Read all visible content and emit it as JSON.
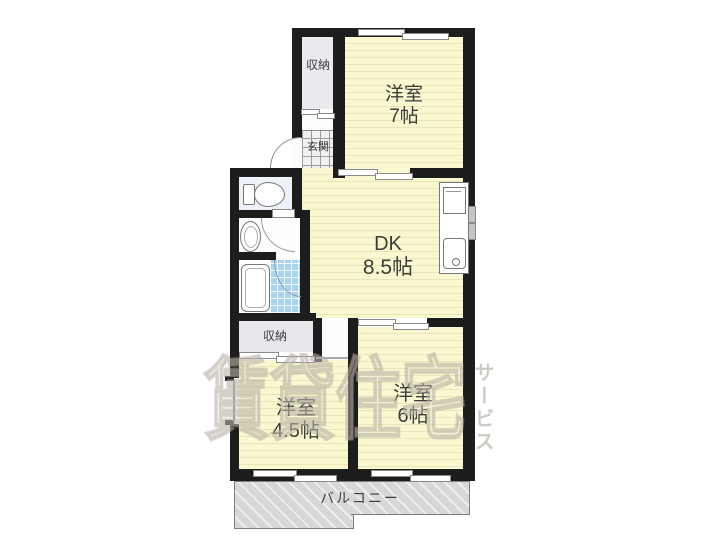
{
  "rooms": {
    "closet_top": {
      "label": "収納"
    },
    "western7": {
      "name": "洋室",
      "size": "7帖"
    },
    "genkan": {
      "label": "玄関"
    },
    "dk": {
      "name": "DK",
      "size": "8.5帖"
    },
    "closet_bottom": {
      "label": "収納"
    },
    "western45": {
      "name": "洋室",
      "size": "4.5帖"
    },
    "western6": {
      "name": "洋室",
      "size": "6帖"
    },
    "balcony": {
      "label": "バルコニー"
    }
  },
  "watermark": {
    "main": "賃貸住宅",
    "vertical": "サービス"
  },
  "colors": {
    "wall": "#1d1d1d",
    "room_yellow": "#faf8d0",
    "closet_gray": "#ece9ee",
    "bath_blue": "#a9d3ef",
    "balcony_gray": "#d7d7d7",
    "label_text": "#3c3c3c",
    "watermark_gray": "#a8a094"
  }
}
